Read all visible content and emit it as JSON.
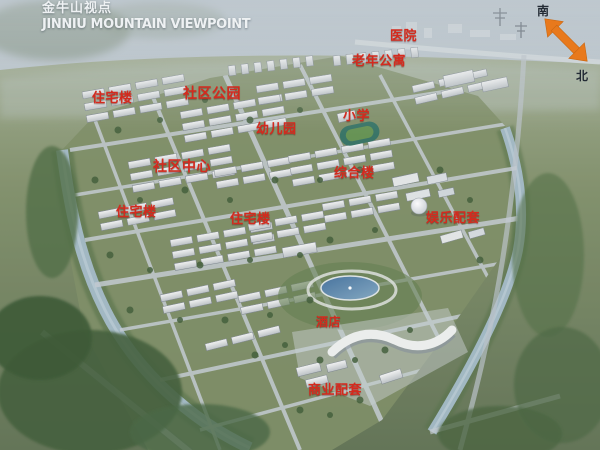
{
  "header": {
    "title_cn": "金牛山视点",
    "title_en": "JINNIU MOUNTAIN VIEWPOINT"
  },
  "compass": {
    "south": "南",
    "north": "北"
  },
  "map_labels": [
    {
      "id": "hospital",
      "text": "医院"
    },
    {
      "id": "senior-apartments",
      "text": "老年公寓"
    },
    {
      "id": "residential-upper-left",
      "text": "住宅楼"
    },
    {
      "id": "community-park",
      "text": "社区公园"
    },
    {
      "id": "kindergarten",
      "text": "幼儿园"
    },
    {
      "id": "primary-school",
      "text": "小学"
    },
    {
      "id": "community-center",
      "text": "社区中心"
    },
    {
      "id": "mixed-use-building",
      "text": "综合楼"
    },
    {
      "id": "residential-mid-left",
      "text": "住宅楼"
    },
    {
      "id": "residential-mid-center",
      "text": "住宅楼"
    },
    {
      "id": "entertainment-amenities",
      "text": "娱乐配套"
    },
    {
      "id": "hotel",
      "text": "酒店"
    },
    {
      "id": "commercial-amenities",
      "text": "商业配套"
    }
  ],
  "colors": {
    "label_red": "#d42a1e",
    "compass_arrow_orange": "#e8791c",
    "title_white": "#eef1f3"
  }
}
